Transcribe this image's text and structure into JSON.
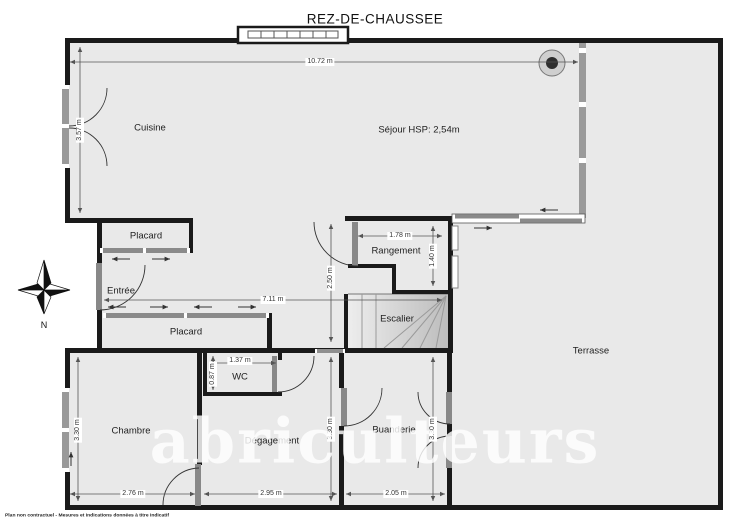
{
  "title": "REZ-DE-CHAUSSEE",
  "rooms": {
    "cuisine": "Cuisine",
    "sejour": "Séjour HSP: 2,54m",
    "placard_haut": "Placard",
    "entree": "Entrée",
    "rangement": "Rangement",
    "escalier": "Escalier",
    "placard_bas": "Placard",
    "wc": "WC",
    "chambre": "Chambre",
    "degagement": "Dégagement",
    "buanderie": "Buanderie",
    "terrasse": "Terrasse"
  },
  "dimensions": {
    "sejour_width": "10.72 m",
    "cuisine_height": "3.57 m",
    "couloir_width": "7.11 m",
    "sejour_mid_height": "2.50 m",
    "rangement_width": "1.78 m",
    "rangement_height": "1.40 m",
    "wc_width": "1.37 m",
    "wc_height": "0.87 m",
    "chambre_height": "3.30 m",
    "degagement_height": "3.30 m",
    "buanderie_height": "3.30 m",
    "chambre_width": "2.76 m",
    "degagement_width": "2.95 m",
    "buanderie_width": "2.05 m"
  },
  "compass": {
    "north_label": "N"
  },
  "watermark": "abriculteurs",
  "disclaimer": "Plan non contractuel - Mesures et indications données à titre indicatif",
  "colors": {
    "wall": "#1a1a1a",
    "floor": "#e9e9e9",
    "opening": "#8f8f8f",
    "dim_line": "#555555"
  }
}
